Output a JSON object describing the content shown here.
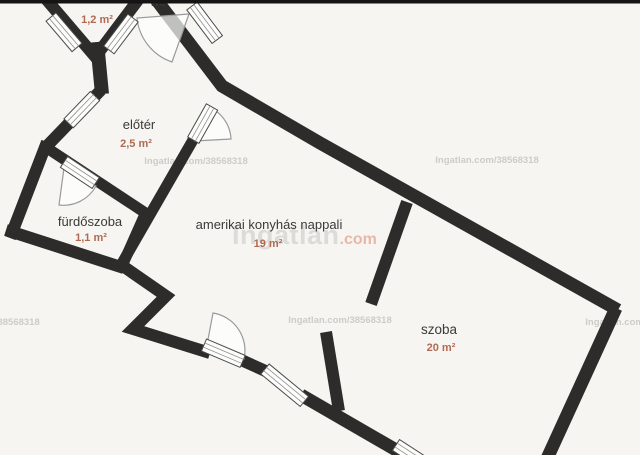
{
  "rooms": [
    {
      "id": "wc",
      "name": "wc",
      "area": "1,2 m²"
    },
    {
      "id": "eloter",
      "name": "előtér",
      "area": "2,5 m²"
    },
    {
      "id": "furdoszoba",
      "name": "fürdőszoba",
      "area": "1,1 m²"
    },
    {
      "id": "nappali",
      "name": "amerikai konyhás nappali",
      "area": "19 m²"
    },
    {
      "id": "szoba",
      "name": "szoba",
      "area": "20 m²"
    }
  ],
  "watermark": {
    "listing_ref": "Ingatlan.com/38568318",
    "brand_gray": "Ingatlan",
    "brand_red": ".com"
  },
  "colors": {
    "background": "#f6f5f2",
    "wall": "#2d2c2a",
    "room_label": "#3b3a38",
    "area_label": "#b06a52",
    "watermark_small": "#c7c5c1",
    "watermark_brand_gray": "#c9c7c3",
    "watermark_brand_red": "#e07a5c"
  }
}
